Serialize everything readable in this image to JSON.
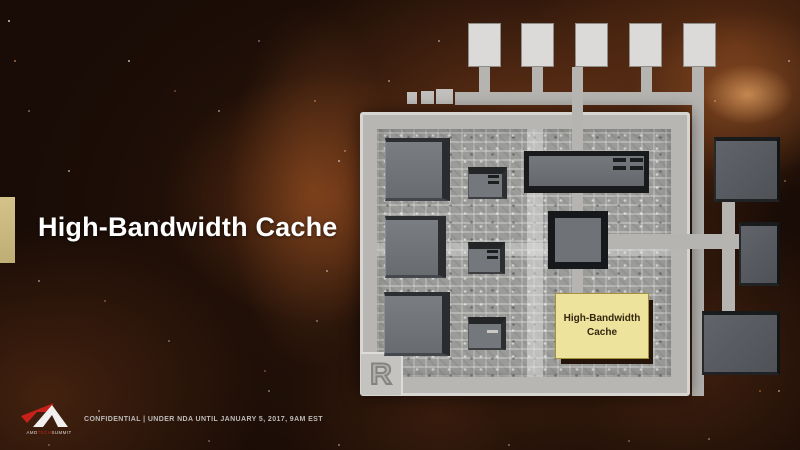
{
  "slide": {
    "title": "High-Bandwidth Cache",
    "footer": {
      "confidential_text": "CONFIDENTIAL | UNDER NDA UNTIL JANUARY 5, 2017, 9AM EST",
      "logo_caption_amd": "AMD",
      "logo_caption_tech": "TECH",
      "logo_caption_summit": "SUMMIT"
    },
    "colors": {
      "accent_bar": "#cdb97e",
      "background_base": "#190c06",
      "title_text": "#ffffff",
      "logo_red": "#c8201a"
    }
  },
  "chip_diagram": {
    "hbc_block": {
      "line1": "High-Bandwidth",
      "line2": "Cache",
      "fill": "#eee39c",
      "text_color": "#33270f"
    },
    "corner_mark": "R",
    "colors": {
      "trace": "#b6b4b1",
      "package_outline": "#d6d5d2",
      "die_base": "#9b9b99",
      "block_face": "#6e7276",
      "pad_fill": "#dbdad8"
    }
  }
}
